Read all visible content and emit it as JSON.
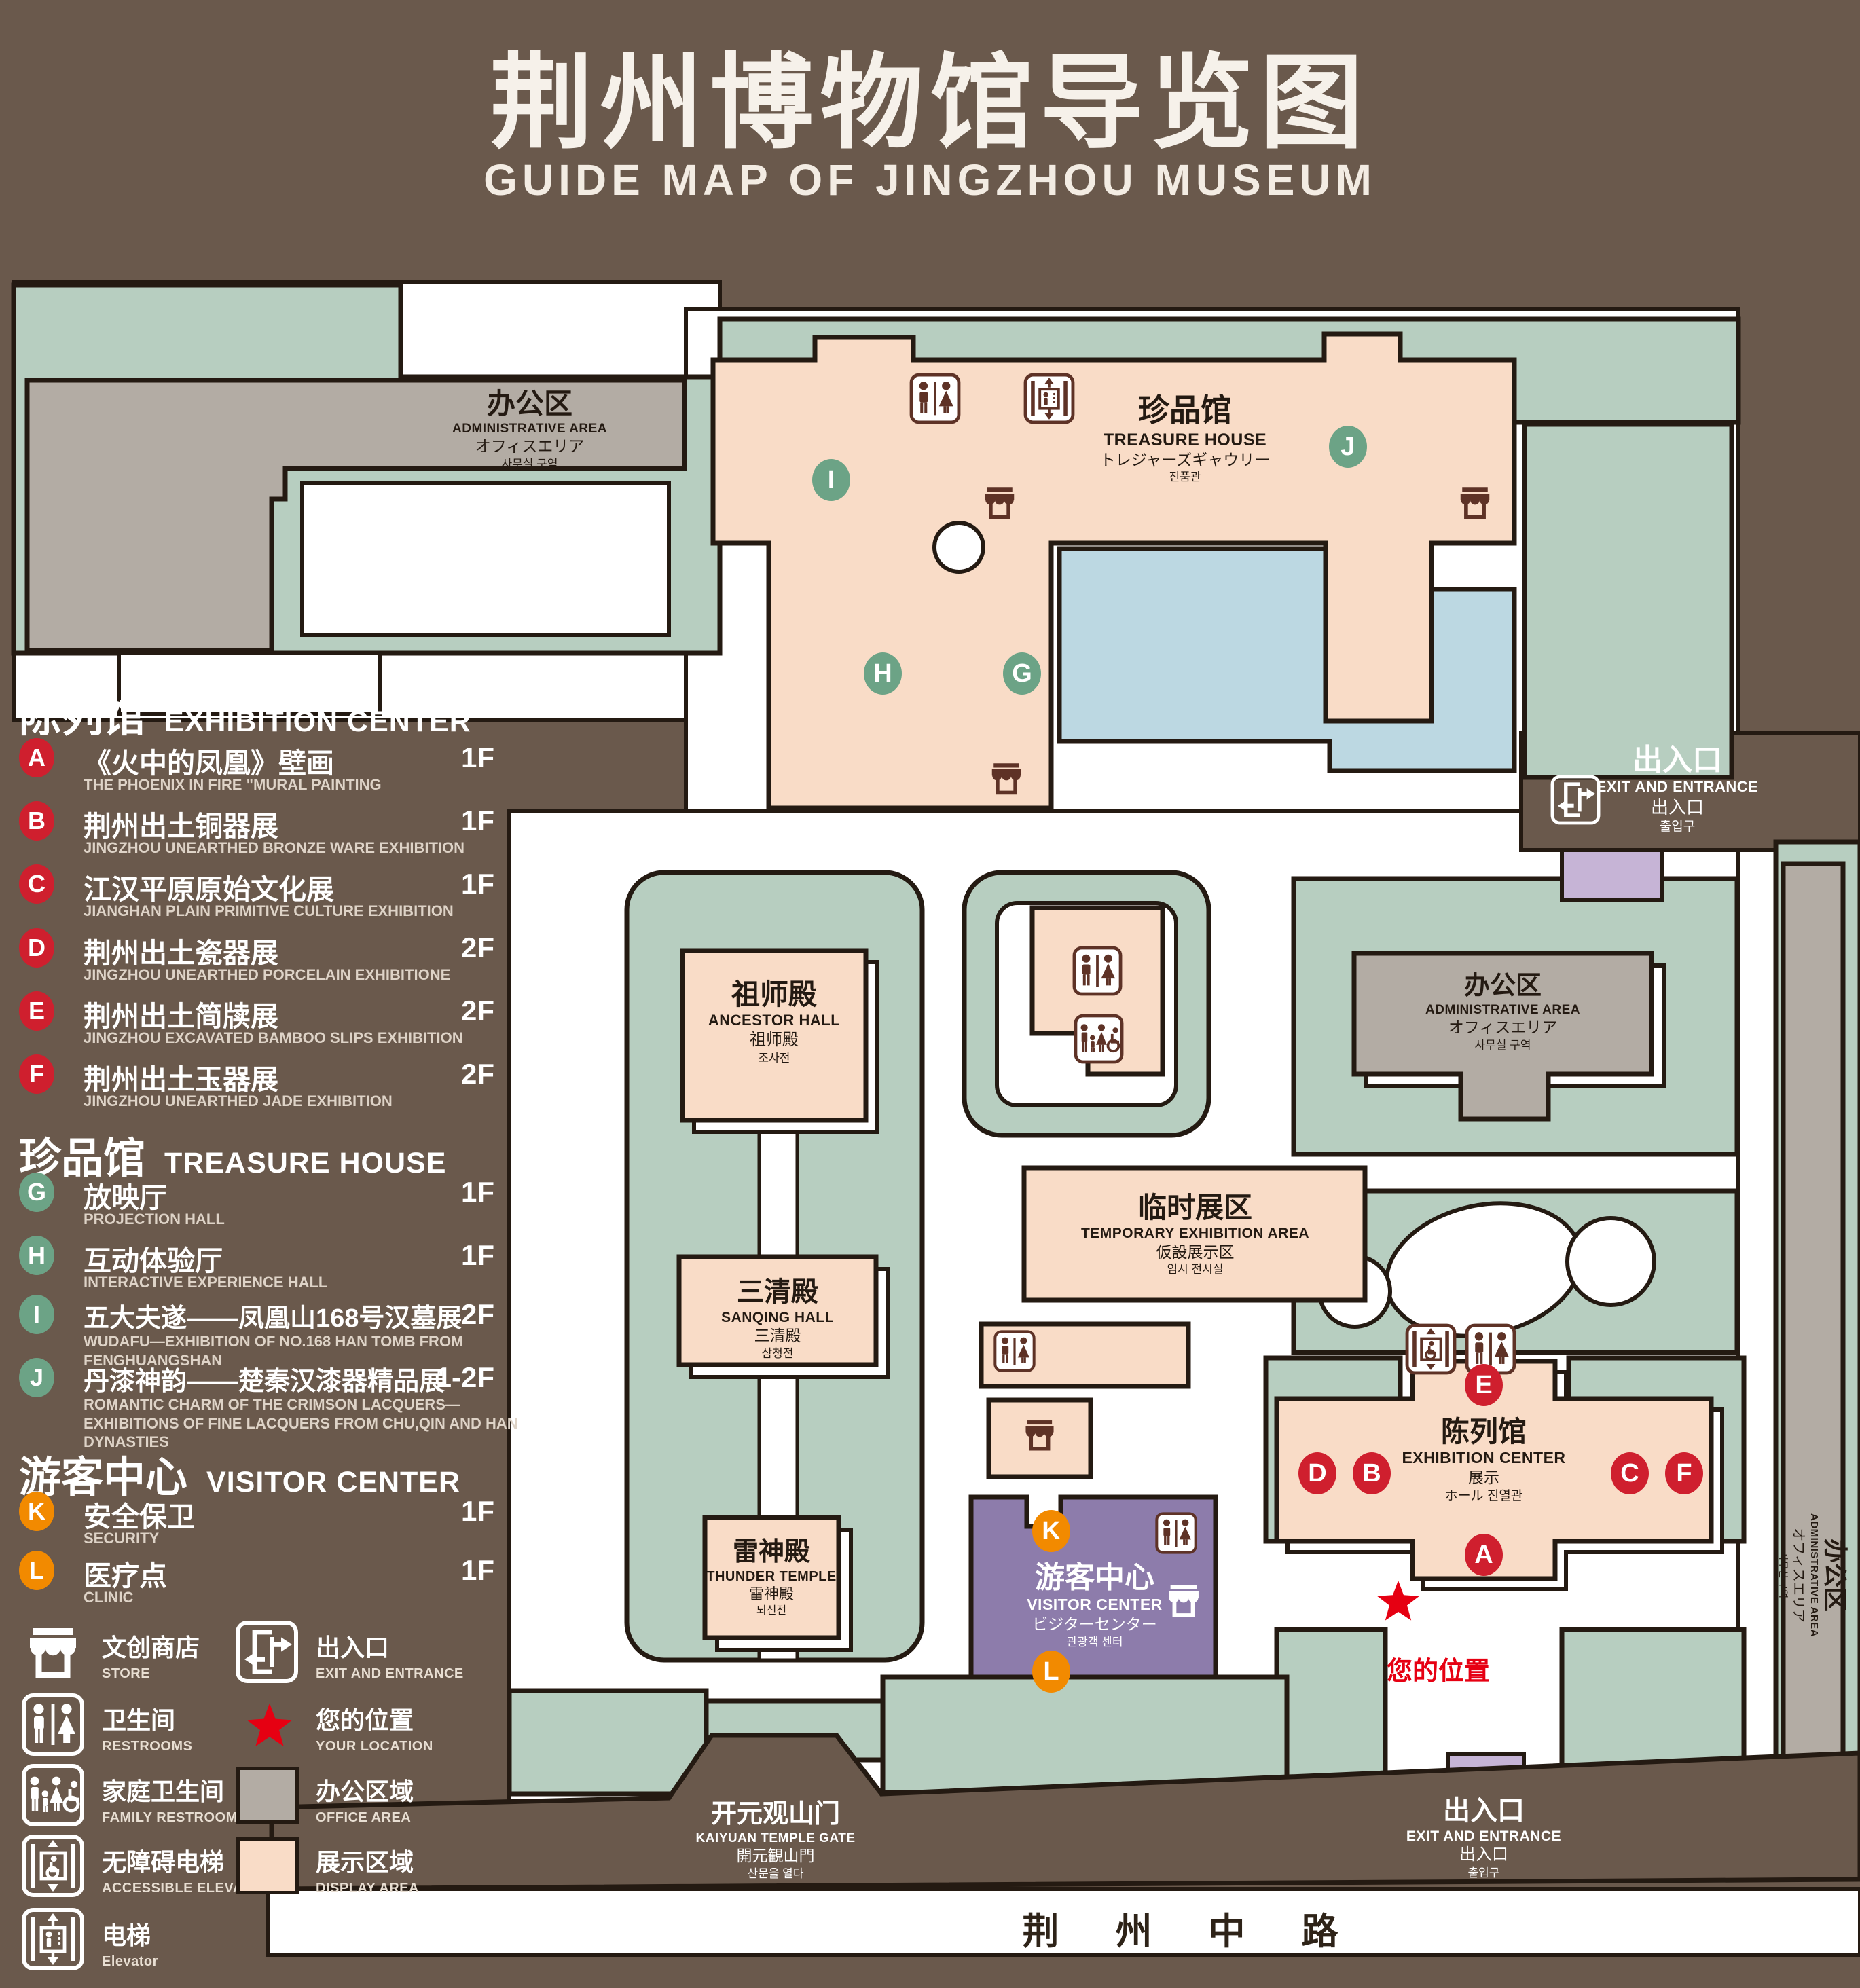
{
  "title": {
    "zh": "荆州博物馆导览图",
    "en": "GUIDE MAP OF JINGZHOU MUSEUM"
  },
  "legend": {
    "sections": [
      {
        "zh": "陈列馆",
        "en": "EXHIBITION CENTER",
        "items": [
          {
            "key": "A",
            "zh": "《火中的凤凰》壁画",
            "en": "THE PHOENIX IN FIRE \"MURAL PAINTING",
            "floor": "1F"
          },
          {
            "key": "B",
            "zh": "荆州出土铜器展",
            "en": "JINGZHOU UNEARTHED BRONZE WARE EXHIBITION",
            "floor": "1F"
          },
          {
            "key": "C",
            "zh": "江汉平原原始文化展",
            "en": "JIANGHAN PLAIN PRIMITIVE CULTURE EXHIBITION",
            "floor": "1F"
          },
          {
            "key": "D",
            "zh": "荆州出土瓷器展",
            "en": "JINGZHOU UNEARTHED PORCELAIN EXHIBITIONE",
            "floor": "2F"
          },
          {
            "key": "E",
            "zh": "荆州出土简牍展",
            "en": "JINGZHOU EXCAVATED BAMBOO SLIPS EXHIBITION",
            "floor": "2F"
          },
          {
            "key": "F",
            "zh": "荆州出土玉器展",
            "en": "JINGZHOU UNEARTHED JADE EXHIBITION",
            "floor": "2F"
          }
        ]
      },
      {
        "zh": "珍品馆",
        "en": "TREASURE HOUSE",
        "items": [
          {
            "key": "G",
            "zh": "放映厅",
            "en": "PROJECTION HALL",
            "floor": "1F"
          },
          {
            "key": "H",
            "zh": "互动体验厅",
            "en": "INTERACTIVE EXPERIENCE HALL",
            "floor": "1F"
          },
          {
            "key": "I",
            "zh": "五大夫遂——凤凰山168号汉墓展",
            "en": "WUDAFU—EXHIBITION OF NO.168 HAN TOMB FROM FENGHUANGSHAN",
            "floor": "2F"
          },
          {
            "key": "J",
            "zh": "丹漆神韵——楚秦汉漆器精品展",
            "en": "ROMANTIC CHARM OF THE CRIMSON LACQUERS—EXHIBITIONS OF FINE LACQUERS FROM CHU,QIN AND HAN DYNASTIES",
            "floor": "1-2F"
          }
        ]
      },
      {
        "zh": "游客中心",
        "en": "VISITOR CENTER",
        "items": [
          {
            "key": "K",
            "zh": "安全保卫",
            "en": "SECURITY",
            "floor": "1F"
          },
          {
            "key": "L",
            "zh": "医疗点",
            "en": "CLINIC",
            "floor": "1F"
          }
        ]
      }
    ],
    "symbols": [
      {
        "zh": "文创商店",
        "en": "STORE"
      },
      {
        "zh": "出入口",
        "en": "EXIT AND ENTRANCE"
      },
      {
        "zh": "卫生间",
        "en": "RESTROOMS"
      },
      {
        "zh": "您的位置",
        "en": "YOUR LOCATION"
      },
      {
        "zh": "家庭卫生间",
        "en": "FAMILY RESTROOMS"
      },
      {
        "zh": "办公区域",
        "en": "OFFICE AREA"
      },
      {
        "zh": "无障碍电梯",
        "en": "ACCESSIBLE ELEVATOR"
      },
      {
        "zh": "展示区域",
        "en": "DISPLAY AREA"
      },
      {
        "zh": "电梯",
        "en": "Elevator"
      }
    ]
  },
  "map": {
    "admin": {
      "zh": "办公区",
      "en": "ADMINISTRATIVE AREA",
      "ja": "オフィスエリア",
      "ko": "사무실 구역"
    },
    "treasure": {
      "zh": "珍品馆",
      "en": "TREASURE HOUSE",
      "ja": "トレジャーズギャウリー",
      "ko": "진품관"
    },
    "ancestor": {
      "zh": "祖师殿",
      "en": "ANCESTOR HALL",
      "ja": "祖师殿",
      "ko": "조사전"
    },
    "temporary": {
      "zh": "临时展区",
      "en": "TEMPORARY EXHIBITION AREA",
      "ja": "仮設展示区",
      "ko": "임시 전시실"
    },
    "sanqing": {
      "zh": "三清殿",
      "en": "SANQING HALL",
      "ja": "三清殿",
      "ko": "삼청전"
    },
    "thunder": {
      "zh": "雷神殿",
      "en": "THUNDER TEMPLE",
      "ja": "雷神殿",
      "ko": "뇌신전"
    },
    "visitor": {
      "zh": "游客中心",
      "en": "VISITOR CENTER",
      "ja": "ビジターセンター",
      "ko": "관광객 센터"
    },
    "exhibition": {
      "zh": "陈列馆",
      "en": "EXHIBITION CENTER",
      "ja": "展示",
      "ko": "ホール 진열관"
    },
    "exit": {
      "zh": "出入口",
      "en": "EXIT AND ENTRANCE",
      "ja": "出入口",
      "ko": "출입구"
    },
    "gate": {
      "zh": "开元观山门",
      "en": "KAIYUAN TEMPLE GATE",
      "ja": "開元観山門",
      "ko": "산문을 열다"
    },
    "your_location": "您的位置",
    "road": "荆 州 中 路"
  },
  "colors": {
    "background": "#6a594c",
    "outline": "#241a12",
    "lawn": "#b7cec0",
    "display_area": "#f9dcc7",
    "office_area": "#b3aca4",
    "visitor_purple": "#8d7cab",
    "entrance_purple": "#c6b4d6",
    "water": "#bcd8e2",
    "marker_red": "#cf1f2e",
    "marker_green": "#6ca386",
    "marker_orange": "#f28a00",
    "icon_maroon": "#5e3226",
    "location_red": "#e60012"
  }
}
